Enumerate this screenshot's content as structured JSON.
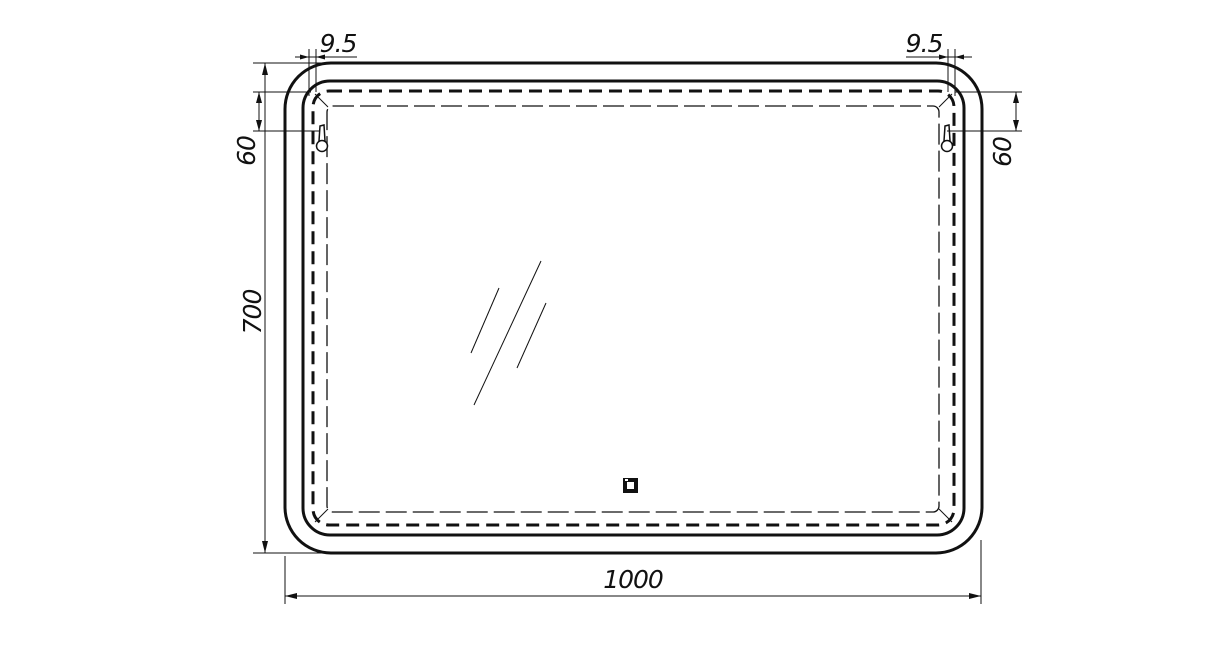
{
  "drawing": {
    "type": "technical-dimension-drawing",
    "subject": "rounded-rectangle LED mirror, front view with hangers and touch sensor",
    "units": "mm"
  },
  "colors": {
    "line": "#111111",
    "background": "#ffffff"
  },
  "dimensions": {
    "total_width": {
      "value": "1000"
    },
    "total_height": {
      "value": "700"
    },
    "hanger_offset_left": {
      "value": "60"
    },
    "hanger_offset_right": {
      "value": "60"
    },
    "edge_inset_left": {
      "value": "9.5"
    },
    "edge_inset_right": {
      "value": "9.5"
    }
  },
  "icons": {
    "hanger": "keyhole-mounting-bracket",
    "touch_sensor": "square-touch-switch",
    "reflection": "glass-shine-lines"
  }
}
